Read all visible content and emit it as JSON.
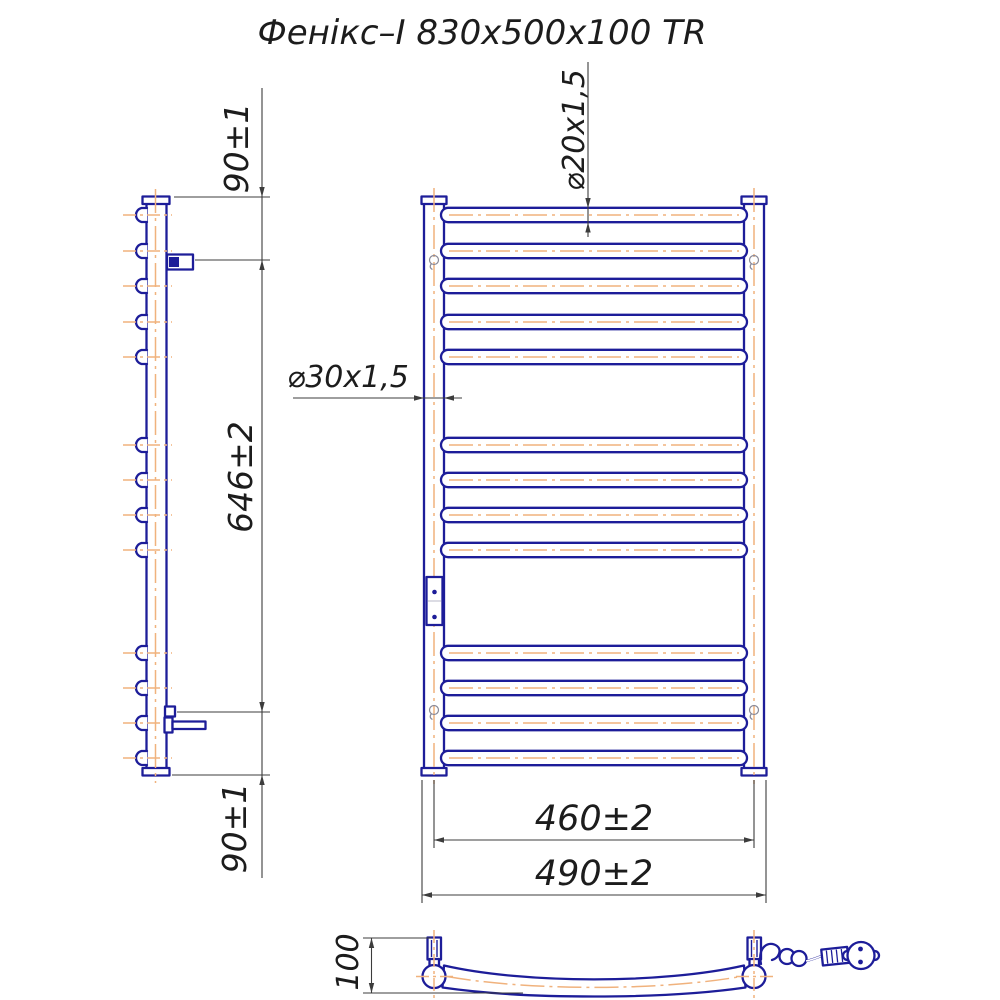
{
  "title": "Фенікс–І 830x500x100 TR",
  "labels": {
    "top_offset": "90±1",
    "span": "646±2",
    "bottom_offset": "90±1",
    "rung_tube": "⌀20x1,5",
    "post_tube": "⌀30x1,5",
    "axis_width": "460±2",
    "overall_width": "490±2",
    "depth": "100"
  },
  "structure": {
    "rung_count": 13,
    "rung_groups": [
      5,
      4,
      4
    ],
    "rung_y": [
      215,
      251,
      286,
      322,
      357,
      445,
      480,
      515,
      550,
      653,
      688,
      723,
      758
    ]
  },
  "colors": {
    "outline": "#1d1d99",
    "centerline": "#f0b27d",
    "dimension": "#3c3c3c",
    "text": "#1c1c1c",
    "background": "#ffffff"
  }
}
